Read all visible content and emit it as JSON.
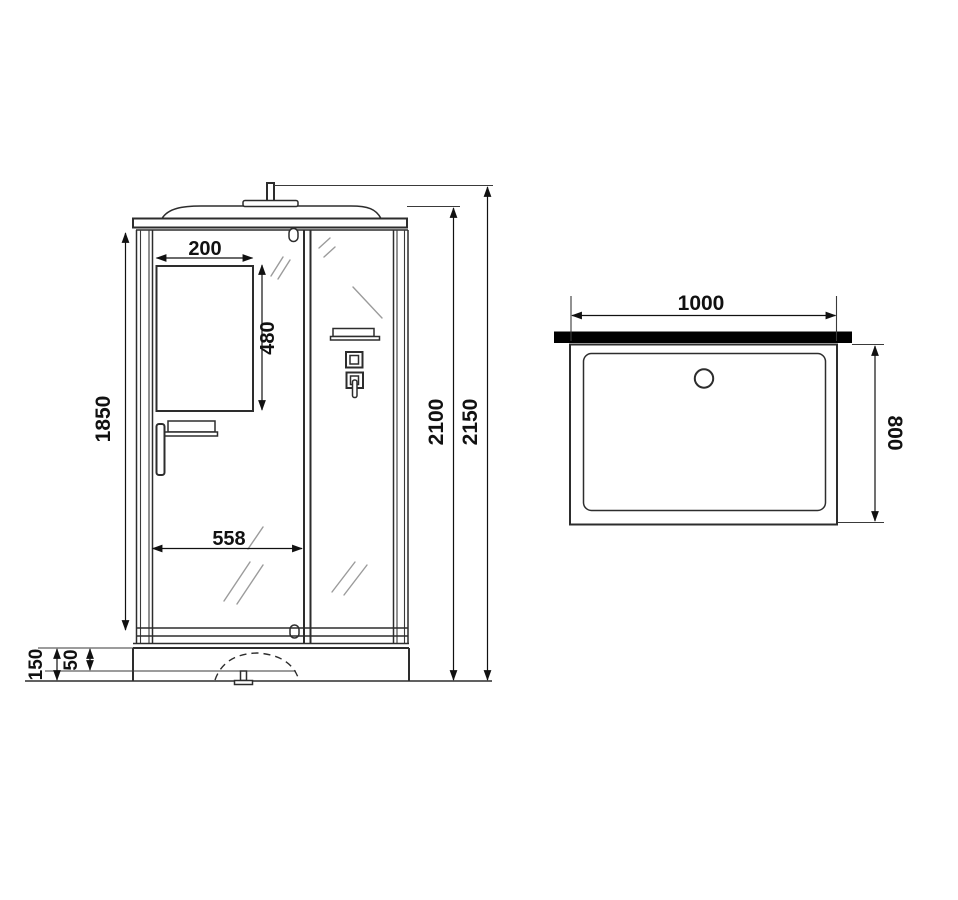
{
  "drawing": {
    "kind": "shower-cabin-dimensional-drawing",
    "front_view": {
      "labels": {
        "window_width": "200",
        "window_height": "480",
        "glass_height": "1850",
        "door_width": "558",
        "cabin_height": "2100",
        "total_height": "2150",
        "base_height": "150",
        "base_inset": "50"
      }
    },
    "top_view": {
      "labels": {
        "tray_width": "1000",
        "tray_depth": "800"
      }
    },
    "colors": {
      "line": "#2d2d2d",
      "dimension": "#111111",
      "wall_fill": "#000000",
      "reflection": "#9b9b9b",
      "background": "#ffffff"
    }
  }
}
